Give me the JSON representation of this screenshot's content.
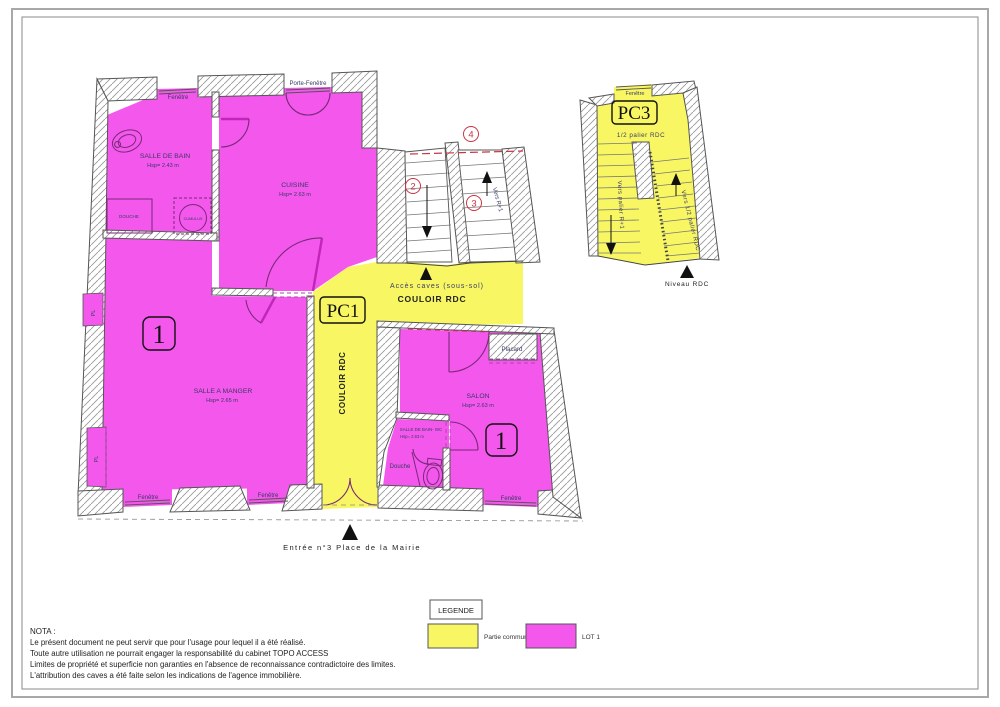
{
  "colors": {
    "lot1_pink": "#f357ec",
    "common_yellow": "#f8f763",
    "annotation_red": "#cc3344",
    "label_blue": "#3a3a66"
  },
  "plan": {
    "windows": {
      "bathroom": "Fenêtre",
      "kitchen": "Porte-Fenêtre",
      "dining_left": "Fenêtre",
      "dining_right": "Fenêtre",
      "salon": "Fenêtre",
      "pc3": "Fenêtre"
    },
    "rooms": {
      "salle_de_bain": {
        "name": "SALLE DE BAIN",
        "height": "Hsp= 2.43 m"
      },
      "douche": "DOUCHE",
      "cumulus": "CUMULUS",
      "cuisine": {
        "name": "CUISINE",
        "height": "Hsp= 2.63 m"
      },
      "salle_a_manger": {
        "name": "SALLE A MANGER",
        "height": "Hsp= 2.65 m"
      },
      "salon": {
        "name": "SALON",
        "height": "Hsp= 2.63 m"
      },
      "salle_de_bain_wc": {
        "name": "SALLE DE BAIN- WC",
        "height": "Hsp= 2.63 m"
      },
      "douche_wc": "Douche",
      "placard": "Placard",
      "pl": "PL"
    },
    "corridor": {
      "label": "COULOIR RDC",
      "pc1": "PC1",
      "acces_caves": "Accès caves (sous-sol)"
    },
    "lot_number": "1",
    "stairwell": {
      "num_2": "2",
      "num_3": "3",
      "num_4": "4",
      "vers_r1": "Vers R+1"
    },
    "pc3": {
      "title": "PC3",
      "window": "Fenêtre",
      "demi_palier": "1/2 palier RDC",
      "vers_palier": "Vers palier R+1",
      "vers_demi_palier": "Vers 1/2 palier RDC",
      "niveau": "Niveau RDC"
    },
    "entrance": "Entrée n°3 Place de la Mairie"
  },
  "legend": {
    "title": "LEGENDE",
    "items": [
      {
        "label": "Partie commune",
        "color": "#f8f763"
      },
      {
        "label": "LOT 1",
        "color": "#f357ec"
      }
    ]
  },
  "nota": {
    "title": "NOTA :",
    "lines": [
      "Le présent document ne peut servir que pour l'usage pour lequel il a été réalisé.",
      "Toute autre utilisation ne pourrait engager la responsabilité du cabinet TOPO ACCESS",
      "Limites de propriété et superficie non garanties en l'absence de reconnaissance contradictoire des limites.",
      "L'attribution des caves a été faite selon les indications de l'agence immobilière."
    ]
  }
}
